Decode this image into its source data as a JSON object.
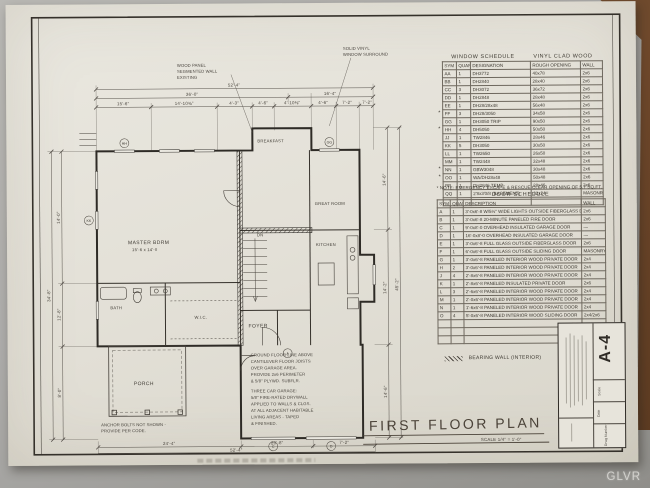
{
  "photo": {
    "watermark": "GLVR"
  },
  "titles": {
    "plan_title": "FIRST FLOOR PLAN",
    "plan_scale": "SCALE  1/4\" = 1'-0\"",
    "sheet_number": "A-4"
  },
  "legend": {
    "bearing_wall": "BEARING WALL (INTERIOR)"
  },
  "window_schedule": {
    "title": "WINDOW SCHEDULE",
    "subtitle": "VINYL CLAD WOOD",
    "columns": [
      "SYM",
      "QUAN",
      "DESIGNATION",
      "ROUGH OPENING",
      "WALL"
    ],
    "rows": [
      {
        "cells": [
          "AA",
          "1",
          "DH3772",
          "40x78",
          "2x6"
        ]
      },
      {
        "cells": [
          "BB",
          "1",
          "DH2840",
          "28x40",
          "2x6"
        ]
      },
      {
        "cells": [
          "CC",
          "3",
          "DH3072",
          "36x72",
          "2x6"
        ]
      },
      {
        "cells": [
          "DD",
          "1",
          "DH2848",
          "28x48",
          "2x6"
        ]
      },
      {
        "cells": [
          "EE",
          "1",
          "DH28/28x48",
          "56x48",
          "2x6"
        ]
      },
      {
        "cells": [
          "FF",
          "3",
          "DH28/3050",
          "34x58",
          "2x6"
        ],
        "flag": true
      },
      {
        "cells": [
          "GG",
          "1",
          "DH3050  TRIP",
          "90x50",
          "2x6"
        ]
      },
      {
        "cells": [
          "HH",
          "4",
          "DH5050",
          "50x50",
          "2x6"
        ],
        "flag": true
      },
      {
        "cells": [
          "JJ",
          "1",
          "TW2846",
          "28x46",
          "2x6"
        ]
      },
      {
        "cells": [
          "KK",
          "5",
          "DH3050",
          "30x50",
          "2x6"
        ]
      },
      {
        "cells": [
          "LL",
          "1",
          "TW2650",
          "26x50",
          "2x6"
        ]
      },
      {
        "cells": [
          "MM",
          "1",
          "TW2448",
          "32x48",
          "2x6"
        ]
      },
      {
        "cells": [
          "NN",
          "1",
          "GBW3048",
          "30x48",
          "2x6"
        ],
        "flag": true
      },
      {
        "cells": [
          "OO",
          "1",
          "WA/DH28x48",
          "50x48",
          "2x6"
        ],
        "flag": true
      },
      {
        "cells": [
          "PP",
          "1",
          "DH2846  TEMP",
          "28x46",
          "2x6"
        ]
      },
      {
        "cells": [
          "QQ",
          "1",
          "2'8x3'0/8  (BASEMENT)",
          "32x24",
          "MASONRY"
        ]
      },
      {
        "cells": [
          "",
          "",
          "",
          "",
          ""
        ]
      }
    ]
  },
  "door_schedule": {
    "note": "* NOTE: EMERGENCY ESCAPE & RESCUE CLEAR OPENING OF 5.7 SQ.FT.",
    "title": "DOOR SCHEDULE",
    "columns": [
      "SYM",
      "QUAN",
      "DESCRIPTION",
      "WALL"
    ],
    "rows": [
      {
        "cells": [
          "A",
          "1",
          "3'-0x6'-8 W/5½\" WIDE LIGHTS OUTSIDE FIBERGLASS DOOR",
          "2x6"
        ]
      },
      {
        "cells": [
          "B",
          "1",
          "3'-0x6'-8 20-MINUTE PANELED FIRE DOOR",
          "2x6"
        ]
      },
      {
        "cells": [
          "C",
          "1",
          "9'-0x8'-0 OVERHEAD INSULATED GARAGE DOOR",
          "—"
        ]
      },
      {
        "cells": [
          "D",
          "1",
          "16'-0x8'-0 OVERHEAD INSULATED GARAGE DOOR",
          "—"
        ]
      },
      {
        "cells": [
          "E",
          "1",
          "3'-0x6'-8 FULL GLASS OUTSIDE FIBERGLASS DOOR",
          "2x6"
        ]
      },
      {
        "cells": [
          "F",
          "1",
          "6'-0x6'-8 FULL GLASS OUTSIDE SLIDING DOOR",
          "MASONRY"
        ]
      },
      {
        "cells": [
          "G",
          "1",
          "3'-0x6'-8 PANELED INTERIOR WOOD PRIVATE DOOR",
          "2x4"
        ]
      },
      {
        "cells": [
          "H",
          "2",
          "3'-0x6'-8 PANELED INTERIOR WOOD PRIVATE DOOR",
          "2x4"
        ]
      },
      {
        "cells": [
          "J",
          "4",
          "2'-8x6'-8 PANELED INTERIOR WOOD PRIVATE DOOR",
          "2x4"
        ]
      },
      {
        "cells": [
          "K",
          "1",
          "2'-8x6'-8 PANELED INSULATED PRIVATE DOOR",
          "2x6"
        ]
      },
      {
        "cells": [
          "L",
          "3",
          "2'-6x6'-8 PANELED INTERIOR WOOD PRIVATE DOOR",
          "2x4"
        ]
      },
      {
        "cells": [
          "M",
          "1",
          "2'-0x6'-8 PANELED INTERIOR WOOD PRIVATE DOOR",
          "2x4"
        ]
      },
      {
        "cells": [
          "N",
          "1",
          "1'-6x6'-8 PANELED INTERIOR WOOD PRIVATE DOOR",
          "2x4"
        ]
      },
      {
        "cells": [
          "O",
          "4",
          "5'-0x6'-8 PANELED INTERIOR WOOD SLIDING DOOR",
          "2x4/2x6"
        ]
      },
      {
        "cells": [
          "",
          "",
          "",
          ""
        ]
      },
      {
        "cells": [
          "",
          "",
          "",
          ""
        ]
      },
      {
        "cells": [
          "",
          "",
          "",
          ""
        ]
      }
    ]
  },
  "title_block": {
    "sheet_number": "A-4",
    "fields": [
      "Drwg Number",
      "Date",
      "Scale"
    ]
  },
  "plan": {
    "rooms": {
      "master": "MASTER BDRM",
      "master_size": "15'-6 x 14'-0",
      "great": "GREAT ROOM",
      "kitchen": "KITCHEN",
      "breakfast": "BREAKFAST",
      "foyer": "FOYER",
      "wic": "W.I.C.",
      "bath": "BATH",
      "porch": "PORCH",
      "dn": "DN"
    },
    "notes": {
      "wall_note": [
        "WOOD PANEL",
        "SEGMENTED WALL",
        "EXISTING"
      ],
      "window_note": [
        "SOLID VINYL",
        "WINDOW SURROUND"
      ],
      "floor_note": [
        "GROUND FLOOR LINE ABOVE",
        "CANTILEVER FLOOR JOISTS",
        "OVER GARAGE AREA.",
        "PROVIDE 2x6 PERIMETER",
        "& 5/8\" PLYWD. SUBFLR."
      ],
      "garage_note": [
        "THREE CAR GARAGE:",
        "5/8\" FIRE-RATED DRYWALL",
        "APPLIED TO WALLS & CLGS.",
        "AT ALL ADJACENT HABITABLE",
        "LIVING AREAS - TAPED",
        "& FINISHED."
      ],
      "anchor_note": [
        "ANCHOR BOLTS NOT SHOWN -",
        "PROVIDE PER CODE."
      ]
    },
    "dims": {
      "top_overall": "52'-4\"",
      "top_mid": [
        "36'-0\"",
        "16'-4\""
      ],
      "top_segs": [
        "15'-6\"",
        "14'-10⅜\"",
        "4'-3\"",
        "4'-6\"",
        "4'-10⅜\"",
        "4'-6\"",
        "7'-2\"",
        "7'-2\""
      ],
      "left_segs": [
        "14'-0\"",
        "12'-8\"",
        "8'-0\""
      ],
      "left_overall": "34'-8\"",
      "right_segs": [
        "14'-6\"",
        "14'-2\"",
        "14'-6\""
      ],
      "right_overall": "45'-2\"",
      "bottom_segs": [
        "24'-4\"",
        "20'-8\"",
        "7'-2\""
      ],
      "bottom_overall": "52'-4\""
    },
    "tags": {
      "w1": "HH",
      "w2": "KK",
      "w3": "GG",
      "d1": "A",
      "d2": "C",
      "d3": "D"
    }
  }
}
